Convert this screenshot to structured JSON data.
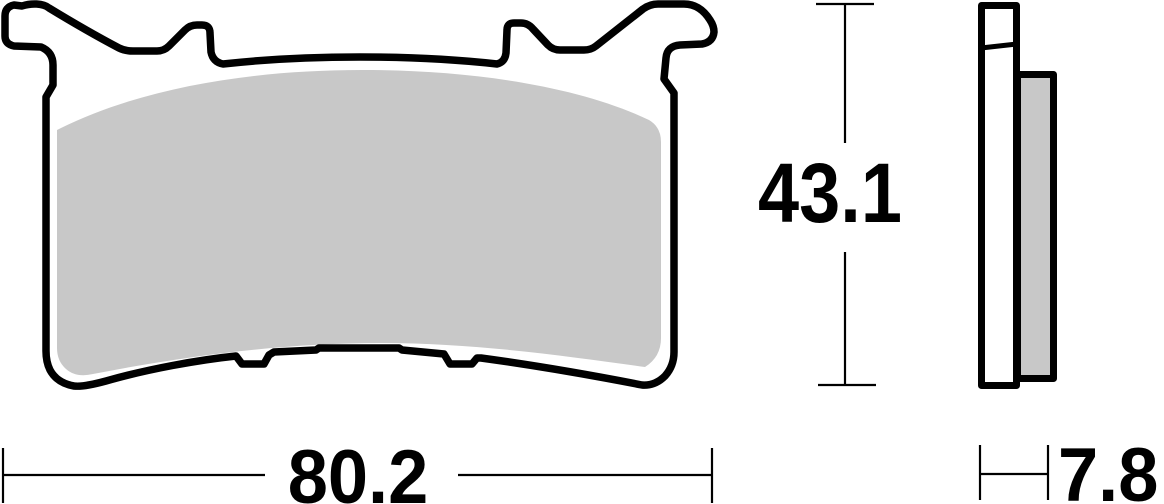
{
  "drawing": {
    "labels": {
      "height": "43.1",
      "width": "80.2",
      "thickness": "7.8"
    },
    "colors": {
      "outline": "#000000",
      "backplate": "#ffffff",
      "friction_material": "#c8c8c8"
    }
  }
}
